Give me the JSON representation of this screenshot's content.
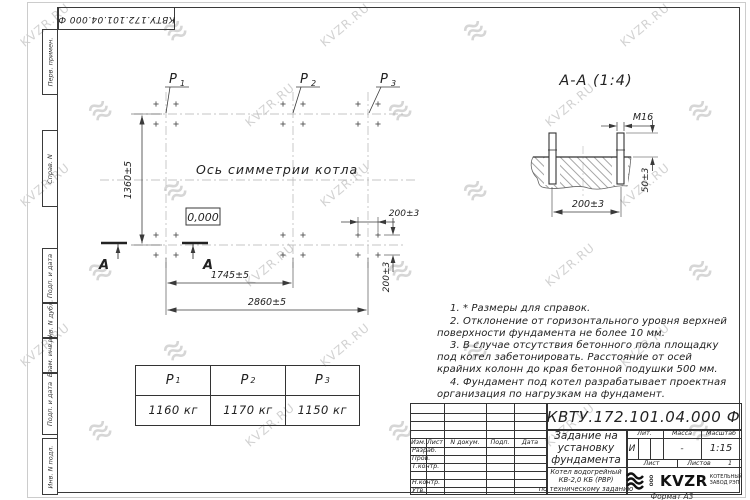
{
  "watermark": {
    "text": "KVZR.RU"
  },
  "stamp_top": {
    "text": "КВТУ.172.101.04.000 Ф"
  },
  "side_strip": {
    "labels": [
      "Перв. примен.",
      "Справ. N",
      "Подп. и дата",
      "Инв. N дубл.",
      "Взам. инв. N",
      "Подп. и дата",
      "Инв. N подл."
    ]
  },
  "plan": {
    "axis_label": "Ось симметрии котла",
    "level": "0,000",
    "section_letter": "А",
    "p_labels": [
      {
        "name": "P",
        "sub": "1"
      },
      {
        "name": "P",
        "sub": "2"
      },
      {
        "name": "P",
        "sub": "3"
      }
    ],
    "dims": {
      "height": "1360±5",
      "span_inner": "1745±5",
      "span_outer": "2860±5",
      "pitch_x": "200±3",
      "pitch_y": "200±3"
    }
  },
  "section_view": {
    "title": "А-А (1:4)",
    "thread": "М16",
    "protrusion": "50±3",
    "pitch": "200±3"
  },
  "notes": [
    "1. * Размеры для справок.",
    "2. Отклонение от горизонтального уровня верхней поверхности фундамента не более 10 мм.",
    "3. В случае отсутствия бетонного пола площадку под котел забетонировать. Расстояние от осей крайних колонн до края бетонной подушки 500 мм.",
    "4. Фундамент под котел разрабатывает проектная организация по нагрузкам на фундамент."
  ],
  "load_table": {
    "col_label": "P",
    "subs": [
      "1",
      "2",
      "3"
    ],
    "values": [
      "1160 кг",
      "1170 кг",
      "1150 кг"
    ]
  },
  "title_block": {
    "doc_number": "КВТУ.172.101.04.000 Ф",
    "title_lines": [
      "Задание на",
      "установку",
      "фундамента"
    ],
    "subtitle_lines": [
      "Котел водогрейный",
      "КВ-2,0 КБ (РВР)",
      "по техническому заданию"
    ],
    "left_headers": [
      "Изм.",
      "Лист",
      "N докум.",
      "Подп.",
      "Дата"
    ],
    "left_rows": [
      "Разраб.",
      "Пров.",
      "Т.контр.",
      "",
      "Н.контр.",
      "Утв."
    ],
    "lit_label": "Лит.",
    "lit_value": "И",
    "mass_label": "Масса",
    "mass_value": "-",
    "scale_label": "Масштаб",
    "scale_value": "1:15",
    "sheet_label": "Лист",
    "sheets_label": "Листов",
    "sheets_value": "1",
    "company": {
      "ooo": "ООО",
      "name": "KVZR",
      "tagline_lines": [
        "КОТЕЛЬНЫЙ",
        "ЗАВОД РЭП"
      ]
    },
    "format": "Формат А3"
  }
}
